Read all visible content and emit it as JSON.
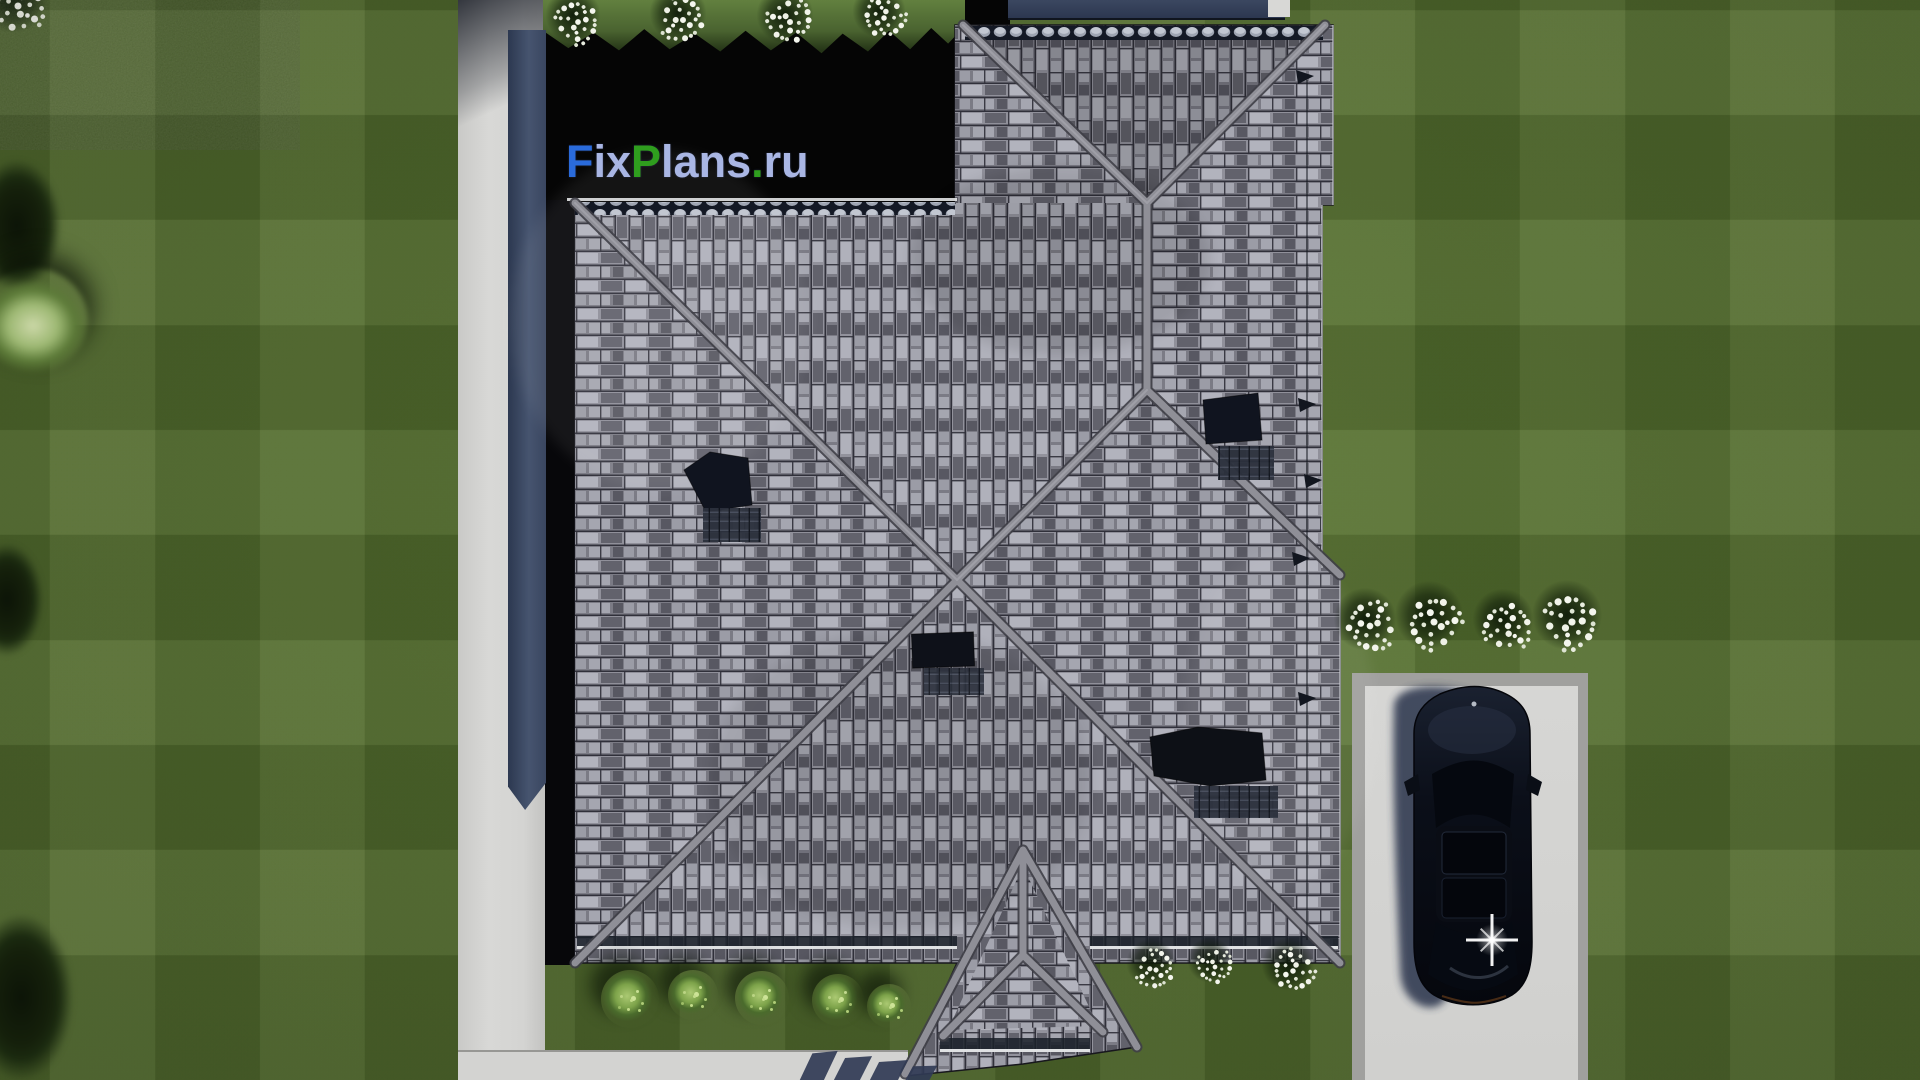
{
  "watermark": {
    "text": "FixPlans.ru",
    "parts": [
      {
        "text": "F",
        "color": "#2a6bdb"
      },
      {
        "text": "ix",
        "color": "#a9b6e4"
      },
      {
        "text": "P",
        "color": "#2f9e1e"
      },
      {
        "text": "lans",
        "color": "#a9b6e4"
      },
      {
        "text": ".",
        "color": "#2f9e1e"
      },
      {
        "text": "ru",
        "color": "#a9b6e4"
      }
    ]
  },
  "palette": {
    "grass": "#4f6530",
    "path": "#d6d6d4",
    "roof-base": "#87878f",
    "roof-dark": "#30303a",
    "roof-light": "#b2b3bd",
    "ridge": "#8f8f97",
    "shadow-navy": "#2d3750",
    "black-area": "#050505",
    "fence": "#3d4d68",
    "driveway": "#d4d4d2",
    "driveway-border": "#a0a09e",
    "car-body": "#0b0f19",
    "flower-white": "#f4f6ee",
    "shrub-green": "#7da34a"
  },
  "scene": {
    "view": "top-down aerial render",
    "house": {
      "roof_style": "hip roof, gray tiles",
      "skylights": 4,
      "solar_panels": 4,
      "porch": "gabled, south side"
    },
    "car": {
      "color": "black",
      "location": "driveway, bottom right"
    },
    "driveway": "concrete pad with border, bottom right",
    "walkway": "L-shaped along west and south sides"
  },
  "objects": {
    "trees": [
      {
        "x": -28,
        "y": 158,
        "w": 100,
        "h": 150,
        "tone": "dark"
      },
      {
        "x": -22,
        "y": 268,
        "w": 110,
        "h": 105,
        "tone": "pale"
      },
      {
        "x": -30,
        "y": 542,
        "w": 82,
        "h": 128,
        "tone": "dark"
      },
      {
        "x": -32,
        "y": 912,
        "w": 118,
        "h": 190,
        "tone": "dark"
      }
    ],
    "flower_clusters": [
      {
        "x": 18,
        "y": 6,
        "s": 66
      },
      {
        "x": 578,
        "y": 22,
        "s": 54
      },
      {
        "x": 683,
        "y": 20,
        "s": 56
      },
      {
        "x": 790,
        "y": 22,
        "s": 56
      },
      {
        "x": 884,
        "y": 18,
        "s": 52
      },
      {
        "x": 1370,
        "y": 626,
        "s": 62
      },
      {
        "x": 1434,
        "y": 622,
        "s": 66
      },
      {
        "x": 1508,
        "y": 626,
        "s": 60
      },
      {
        "x": 1572,
        "y": 622,
        "s": 68
      },
      {
        "x": 1156,
        "y": 970,
        "s": 48
      },
      {
        "x": 1215,
        "y": 967,
        "s": 44
      },
      {
        "x": 1293,
        "y": 971,
        "s": 52
      }
    ],
    "shrubs": [
      {
        "x": 630,
        "y": 999,
        "s": 58
      },
      {
        "x": 693,
        "y": 995,
        "s": 50
      },
      {
        "x": 762,
        "y": 998,
        "s": 54
      },
      {
        "x": 838,
        "y": 1000,
        "s": 52
      },
      {
        "x": 889,
        "y": 1006,
        "s": 44
      }
    ],
    "ground_shadows": [
      {
        "x": 806,
        "y": 1052,
        "w": 24,
        "h": 30,
        "r": -6
      },
      {
        "x": 838,
        "y": 1057,
        "w": 26,
        "h": 30,
        "r": -4
      },
      {
        "x": 872,
        "y": 1061,
        "w": 28,
        "h": 30,
        "r": -4
      },
      {
        "x": 906,
        "y": 1066,
        "w": 24,
        "h": 26,
        "r": -2
      }
    ]
  }
}
